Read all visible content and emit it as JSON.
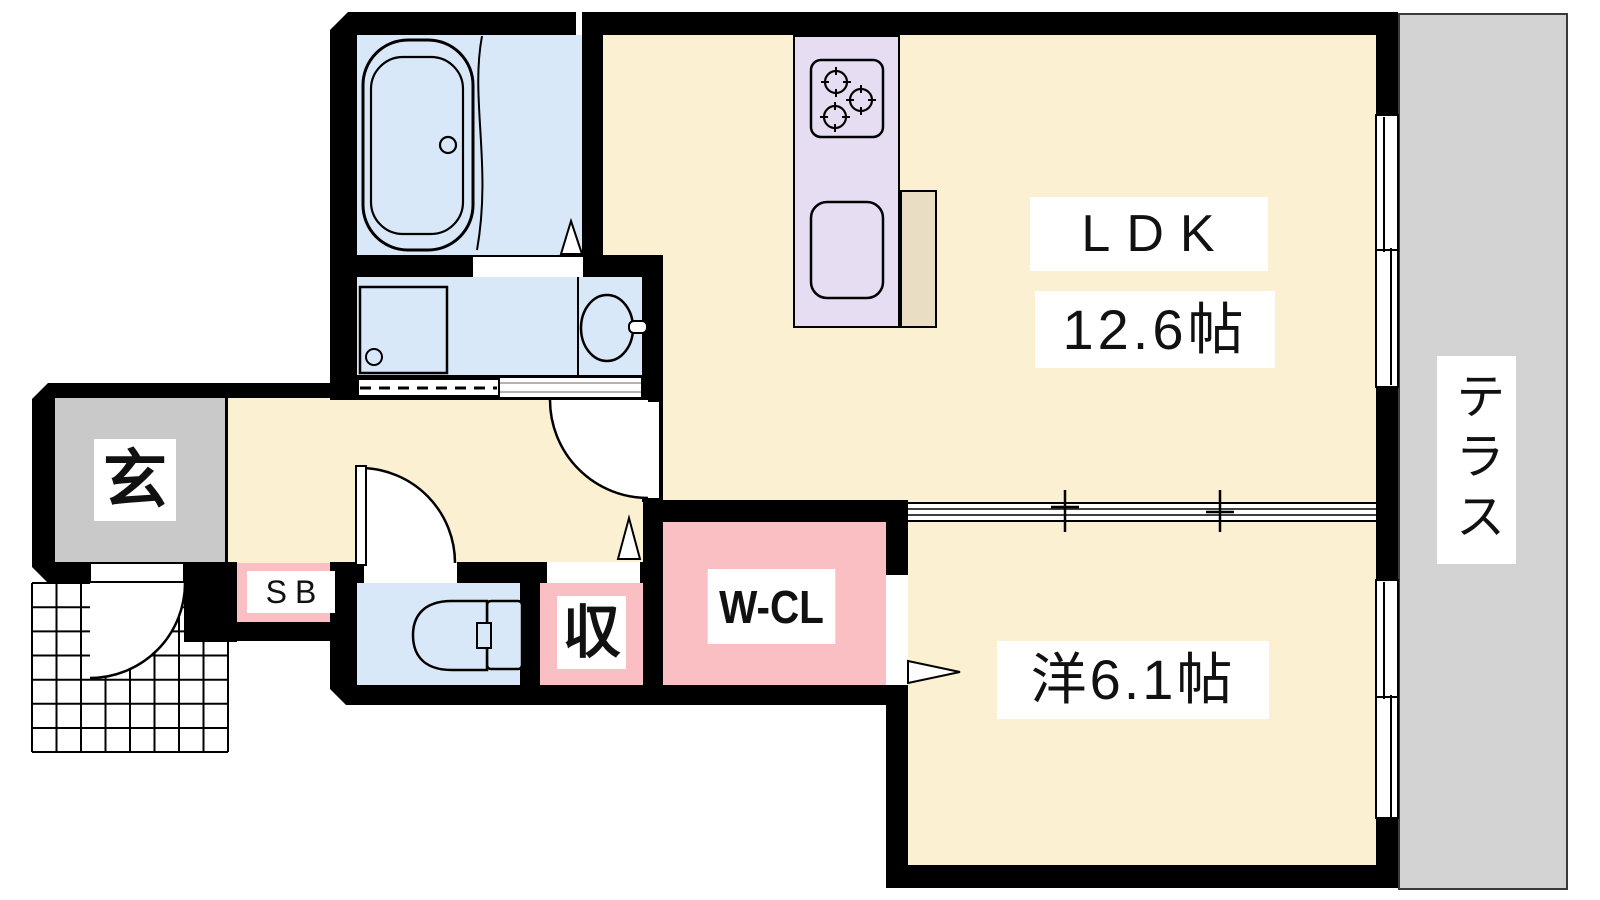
{
  "plan": {
    "title": "1LDK apartment floor plan",
    "labels": {
      "ldk": "LDK",
      "ldk_size": "12.6帖",
      "western_room": "洋6.1帖",
      "terrace": "テラス",
      "entrance": "玄",
      "shoe_box": "SB",
      "storage": "収",
      "walk_in_closet": "W-CL"
    },
    "fixtures": {
      "bathtub": "bathtub-icon",
      "shower_curtain": "shower-curtain-icon",
      "washing_machine_pan": "washing-machine-pan-icon",
      "wash_basin": "wash-basin-icon",
      "toilet": "toilet-icon",
      "gas_stove": "gas-stove-icon",
      "kitchen_sink": "kitchen-sink-icon",
      "entry_door": "door-swing-icon",
      "toilet_door": "door-swing-icon",
      "ldk_door": "door-swing-icon",
      "partition": "sliding-door-icon",
      "windows": "window-icon",
      "porch": "tiled-porch-icon"
    },
    "palette": {
      "room_cream": "#fbf0d2",
      "water_blue": "#d9e8f8",
      "closet_pink": "#f9bfc3",
      "entry_gray": "#c9c9c9",
      "terrace_gray": "#d3d3d3",
      "kitchen_lavender": "#e6ddf3",
      "counter_beige": "#e9ddc4",
      "wall_black": "#000000"
    }
  }
}
